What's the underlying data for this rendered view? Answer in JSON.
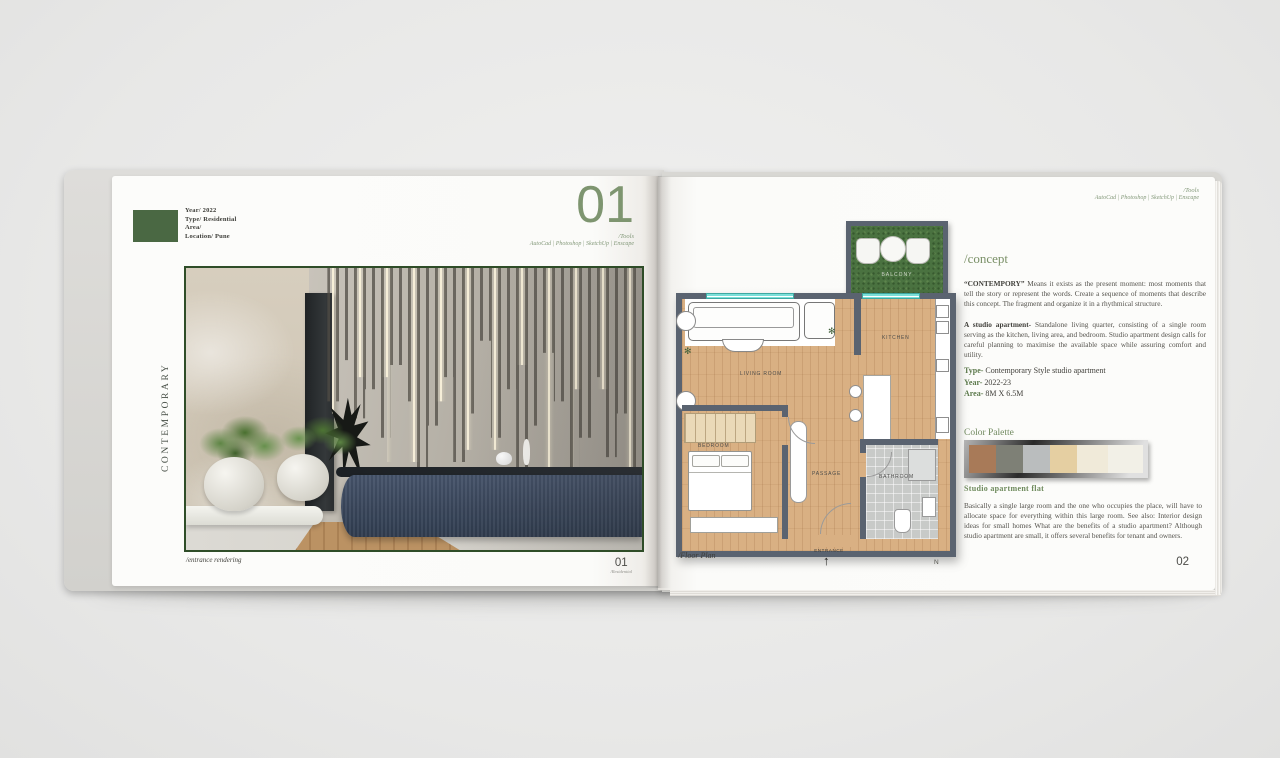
{
  "theme": {
    "accent_green": "#7b9168",
    "label_block_green": "#4a6843"
  },
  "left_page": {
    "meta": {
      "lines": [
        "Year/ 2022",
        "Type/ Residential",
        "Area/",
        "Location/ Pune"
      ]
    },
    "chapter_number": "01",
    "tools_label": "/Tools",
    "tools_list": "AutoCad | Photoshop | SketchUp | Enscape",
    "vertical_title": "CONTEMPORARY",
    "image_caption": "/entrance rendering",
    "page_number": "01",
    "page_number_sub": "/Residential"
  },
  "right_page": {
    "tools_label": "/Tools",
    "tools_list": "AutoCad | Photoshop | SketchUp | Enscape",
    "floorplan": {
      "rooms": {
        "living": "LIVING ROOM",
        "kitchen": "KITCHEN",
        "bedroom": "BEDROOM",
        "passage": "PASSAGE",
        "bathroom": "BATHROOM",
        "balcony": "BALCONY"
      },
      "entrance_label": "ENTRANCE",
      "entrance_arrow": "↑",
      "caption": "/Floor Plan",
      "compass": "N",
      "plant_glyph": "✻",
      "flower_glyph": "❋"
    },
    "concept": {
      "heading": "/concept",
      "para1_lead": "“CONTEMPORY”",
      "para1_rest": " Means it exists as the present moment: most moments that tell the story or represent the words. Create a sequence of moments that describe this concept. The fragment and organize it in a rhythmical structure.",
      "para2_lead": "A studio apartment-",
      "para2_rest": " Standalone living quarter, consisting of a single room serving as the kitchen, living area, and bedroom. Studio apartment design calls for careful planning to maximise the available space while assuring comfort and utility."
    },
    "specs": [
      {
        "label": "Type-",
        "value": " Contemporary Style studio apartment"
      },
      {
        "label": "Year-",
        "value": " 2022-23"
      },
      {
        "label": "Area-",
        "value": " 8M X 6.5M"
      }
    ],
    "palette": {
      "heading": "Color Palette",
      "colors": [
        "#a87a58",
        "#7e8076",
        "#babdbe",
        "#e5cfa2",
        "#f0ead9",
        "#f2f0e7"
      ]
    },
    "studio": {
      "heading": "Studio apartment flat",
      "body": "Basically a single large room and the one who occupies the place, will have to allocate space for everything within this large room. See also: Interior design ideas for small homes What are the benefits of a studio apartment? Although studio apartment are small, it offers several benefits for tenant and owners."
    },
    "page_number": "02"
  }
}
